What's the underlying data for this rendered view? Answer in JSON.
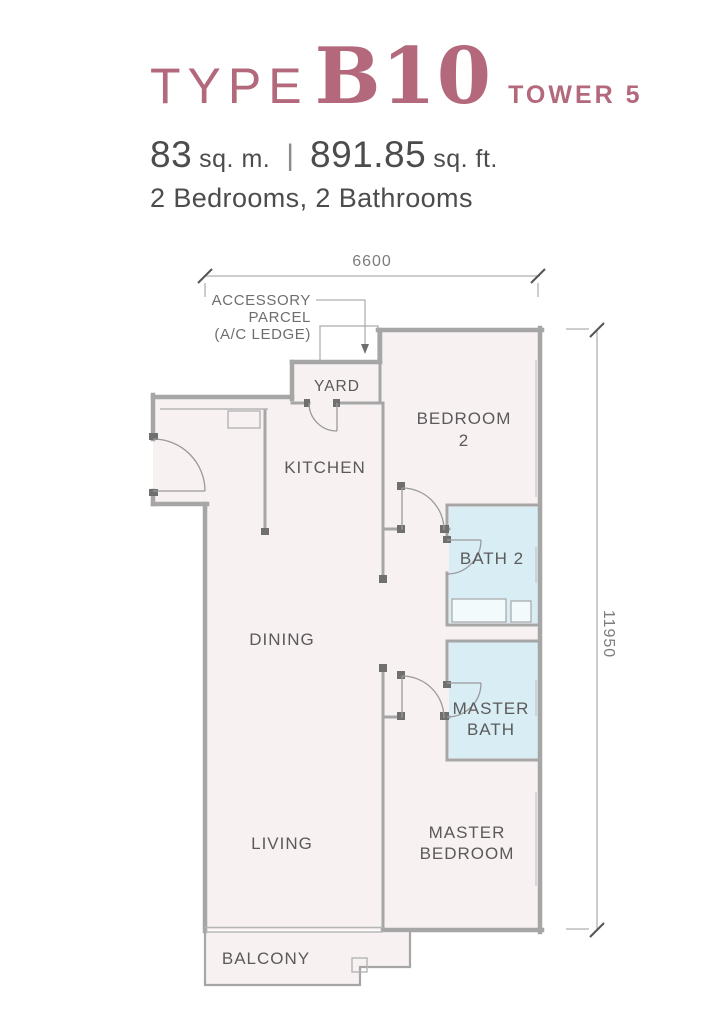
{
  "header": {
    "type_label": "TYPE",
    "unit_code": "B10",
    "tower": "TOWER 5",
    "area_sqm_value": "83",
    "area_sqm_unit": "sq. m.",
    "pipe": "|",
    "area_sqft_value": "891.85",
    "area_sqft_unit": "sq. ft.",
    "config": "2 Bedrooms, 2 Bathrooms"
  },
  "floorplan": {
    "dimensions": {
      "width_mm": "6600",
      "height_mm": "11950"
    },
    "annotation": {
      "line1": "ACCESSORY",
      "line2": "PARCEL",
      "line3": "(A/C LEDGE)"
    },
    "rooms": {
      "yard": "YARD",
      "kitchen": "KITCHEN",
      "bedroom2_l1": "BEDROOM",
      "bedroom2_l2": "2",
      "bath2": "BATH 2",
      "dining": "DINING",
      "master_bath_l1": "MASTER",
      "master_bath_l2": "BATH",
      "living": "LIVING",
      "master_bedroom_l1": "MASTER",
      "master_bedroom_l2": "BEDROOM",
      "balcony": "BALCONY"
    },
    "colors": {
      "accent_rose": "#b3697b",
      "room_fill": "#f7f1f2",
      "bath_fill": "#d9edf5",
      "wall_gray": "#a6a6a6",
      "label_gray": "#5a5a5a",
      "text_dark": "#4c4c4c"
    }
  }
}
